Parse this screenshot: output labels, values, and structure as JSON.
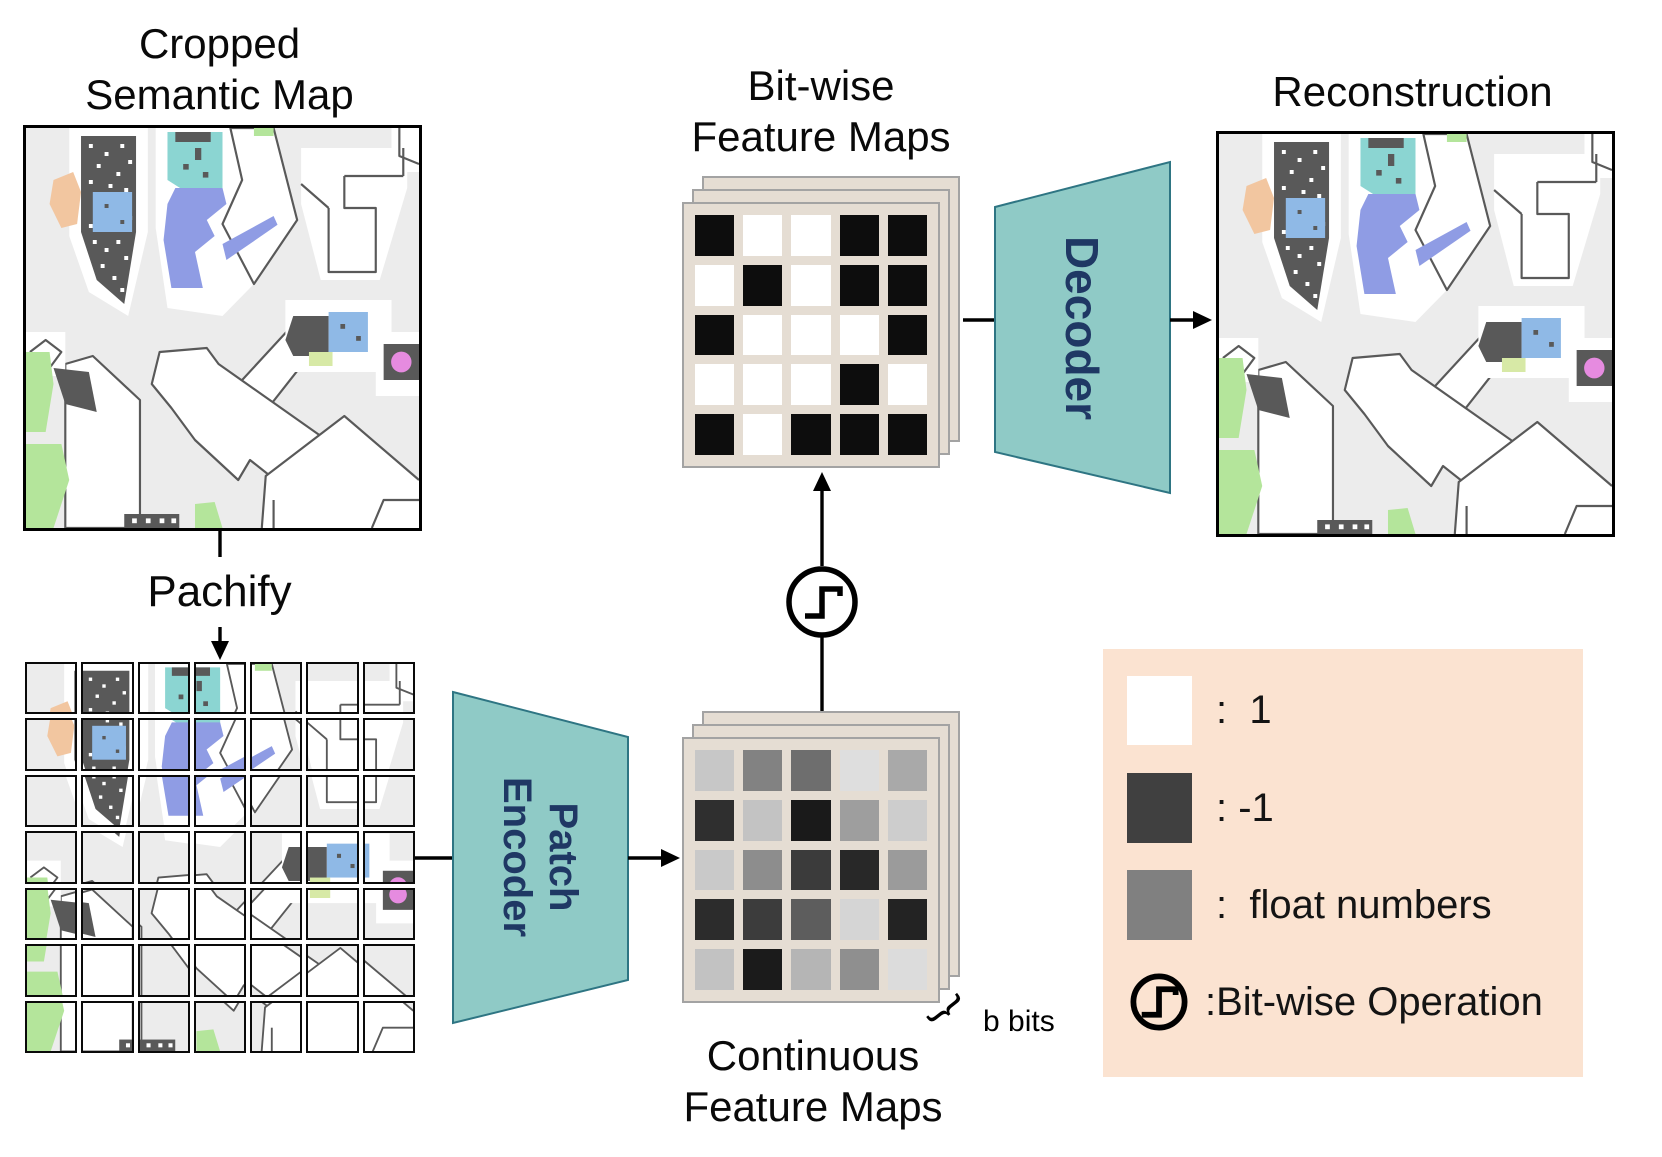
{
  "titles": {
    "cropped_map_l1": "Cropped",
    "cropped_map_l2": "Semantic Map",
    "patchify": "Pachify",
    "bitwise_l1": "Bit-wise",
    "bitwise_l2": "Feature Maps",
    "continuous_l1": "Continuous",
    "continuous_l2": "Feature Maps",
    "reconstruction": "Reconstruction",
    "bits_annotation": "b bits",
    "brace_glyph": "}"
  },
  "blocks": {
    "patch_encoder_l1": "Patch",
    "patch_encoder_l2": "Encoder",
    "decoder": "Decoder"
  },
  "legend": {
    "items": [
      {
        "swatch_color": "#FFFFFF",
        "label": ":  1"
      },
      {
        "swatch_color": "#404040",
        "label": ": -1"
      },
      {
        "swatch_color": "#808080",
        "label": ":  float numbers"
      },
      {
        "swatch_color": "step_icon",
        "label": ":Bit-wise Operation"
      }
    ]
  },
  "grids": {
    "patch_rows": 7,
    "patch_cols": 7,
    "bitwise_values": [
      [
        -1,
        1,
        1,
        -1,
        -1
      ],
      [
        1,
        -1,
        1,
        -1,
        -1
      ],
      [
        -1,
        1,
        1,
        1,
        -1
      ],
      [
        1,
        1,
        1,
        -1,
        1
      ],
      [
        -1,
        1,
        -1,
        -1,
        -1
      ]
    ],
    "continuous_values": [
      [
        "#C7C7C7",
        "#828282",
        "#6E6E6E",
        "#DEDEDE",
        "#A9A9A9"
      ],
      [
        "#2F2F2F",
        "#C3C3C3",
        "#1A1A1A",
        "#9E9E9E",
        "#CDCDCD"
      ],
      [
        "#C9C9C9",
        "#8D8D8D",
        "#3B3B3B",
        "#282828",
        "#9B9B9B"
      ],
      [
        "#2C2C2C",
        "#3C3C3C",
        "#5D5D5D",
        "#D5D5D5",
        "#232323"
      ],
      [
        "#C2C2C2",
        "#1B1B1B",
        "#B5B5B5",
        "#8F8F8F",
        "#DCDCDC"
      ]
    ]
  },
  "colors": {
    "teal_fill": "#8FCAC6",
    "teal_stroke": "#2E7583",
    "navy_text": "#1F3864",
    "card_bg": "#E5DDD3",
    "card_border": "#A3A3A3",
    "legend_bg": "#FBE3D1",
    "bit_white": "#FFFFFF",
    "bit_black": "#0D0D0D",
    "arrow_black": "#000000",
    "map": {
      "bg": "#ECECEC",
      "wall": "#595959",
      "white": "#FFFFFF",
      "cyan": "#8BD5D2",
      "periwinkle": "#8F9CE4",
      "blue": "#8FB9E6",
      "peach": "#F2C6A0",
      "green": "#B4E59B",
      "yellow_green": "#D7E9A6",
      "magenta": "#E68BE0"
    }
  }
}
